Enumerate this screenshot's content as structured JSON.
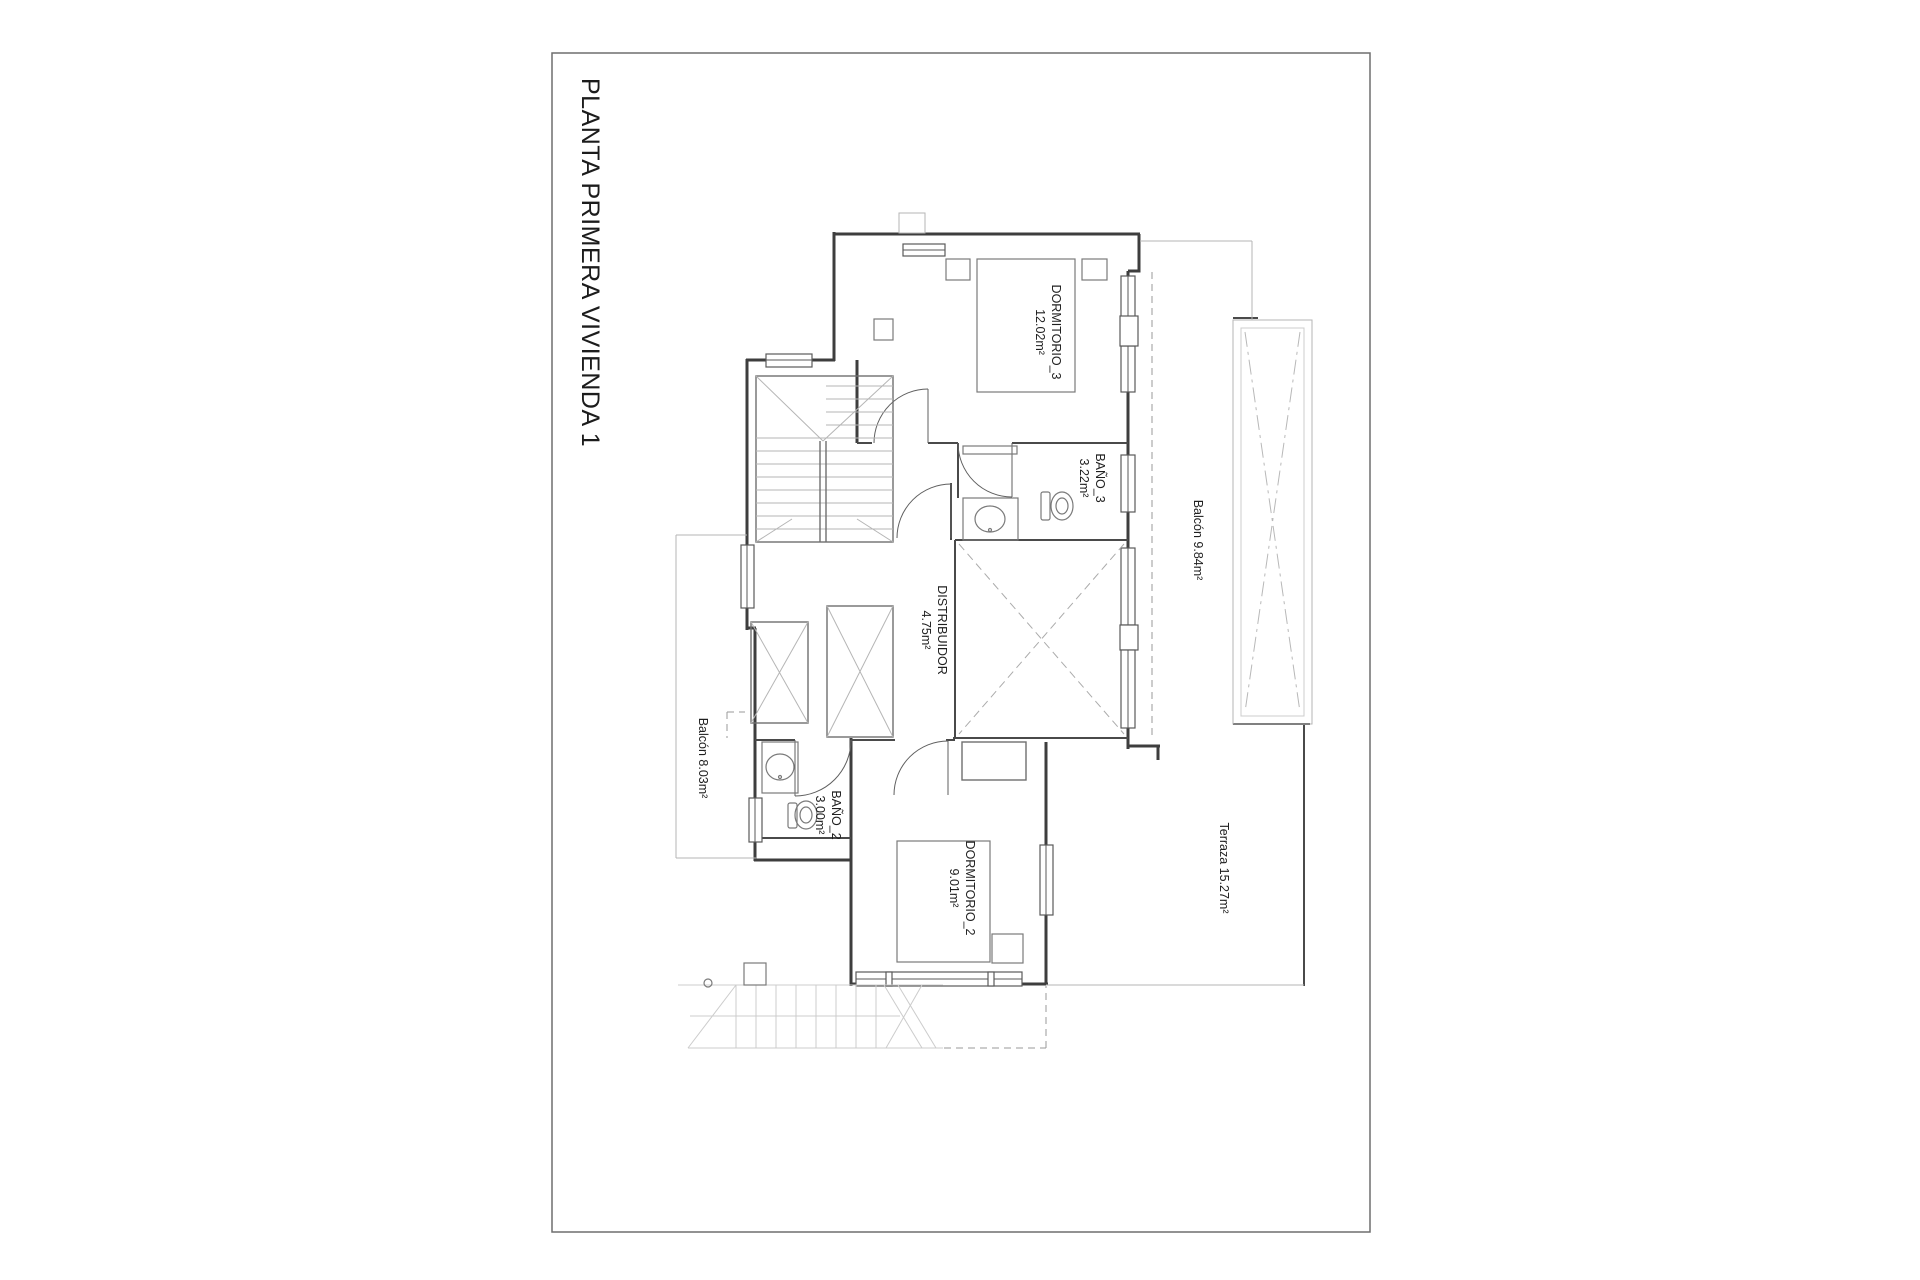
{
  "sheet": {
    "title": "PLANTA PRIMERA VIVIENDA 1"
  },
  "labels": {
    "dormitorio3_name": "DORMITORIO_3",
    "dormitorio3_area": "12.02m²",
    "bano3_name": "BAÑO_3",
    "bano3_area": "3.22m²",
    "balcon_ne": "Balcón 9.84m²",
    "distribuidor_name": "DISTRIBUIDOR",
    "distribuidor_area": "4.75m²",
    "balcon_w": "Balcón 8.03m²",
    "bano2_name": "BAÑO_2",
    "bano2_area": "3.00m²",
    "dormitorio2_name": "DORMITORIO_2",
    "dormitorio2_area": "9.01m²",
    "terraza": "Terraza 15.27m²"
  },
  "colors": {
    "paper": "#ffffff",
    "frame": "#6e6e6e",
    "wall": "#3e3e3e",
    "fixture": "#7a7a7a",
    "light_line": "#b5b5b5",
    "dashed_line": "#9a9a9a",
    "text": "#1f1f1f"
  }
}
